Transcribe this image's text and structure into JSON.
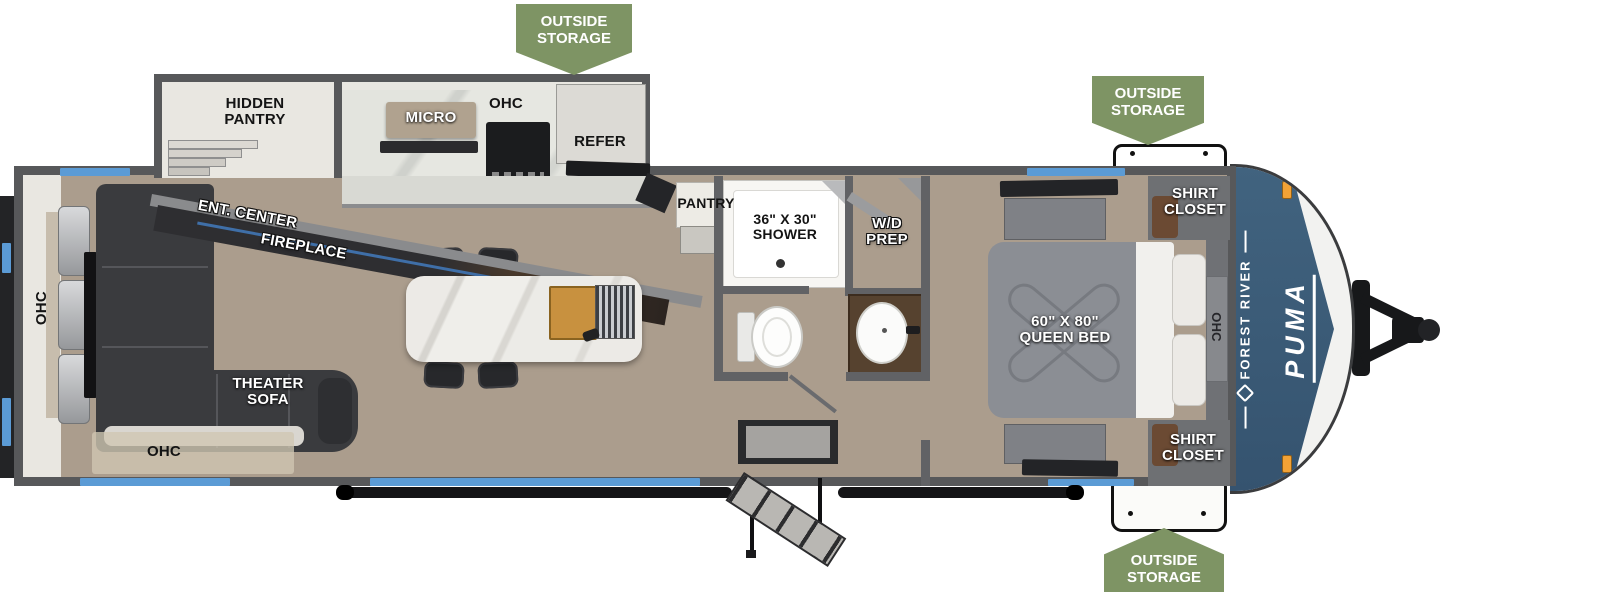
{
  "canvas": {
    "width": 1600,
    "height": 592
  },
  "colors": {
    "badge_green": "#7E9464",
    "cap_blue": "#3C5A78",
    "window_blue": "#5B9BD5",
    "wall_gray": "#57585A",
    "floor_tan": "#AB9D8D"
  },
  "badges": {
    "top_center": "OUTSIDE\nSTORAGE",
    "top_right": "OUTSIDE\nSTORAGE",
    "bottom_right": "OUTSIDE\nSTORAGE"
  },
  "labels": {
    "hidden_pantry": "HIDDEN\nPANTRY",
    "micro": "MICRO",
    "kitchen_ohc": "OHC",
    "refer": "REFER",
    "ent_center": "ENT. CENTER",
    "fireplace": "FIREPLACE",
    "rear_ohc": "OHC",
    "theater_sofa": "THEATER\nSOFA",
    "sofa_ohc": "OHC",
    "pantry": "PANTRY",
    "shower": "36\" X 30\"\nSHOWER",
    "wd_prep": "W/D\nPREP",
    "queen_bed": "60\" X 80\"\nQUEEN BED",
    "shirt_closet_top": "SHIRT\nCLOSET",
    "shirt_closet_bottom": "SHIRT\nCLOSET",
    "bedroom_ohc": "OHC"
  },
  "branding": {
    "make": "FOREST RIVER",
    "model": "PUMA"
  }
}
